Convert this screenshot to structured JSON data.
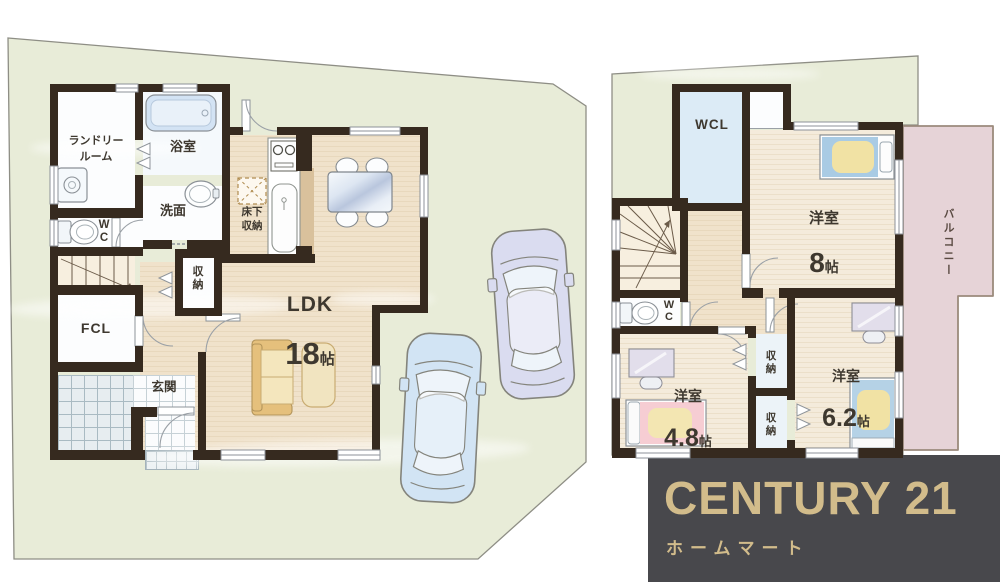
{
  "floor1": {
    "laundry": "ランドリー\nルーム",
    "bath": "浴室",
    "washroom": "洗面",
    "wc": "W\nC",
    "storage": "収\n納",
    "underfloor_storage": "床下\n収納",
    "ldk": "LDK",
    "ldk_size": "18",
    "ldk_unit": "帖",
    "fcl": "FCL",
    "entrance": "玄関"
  },
  "floor2": {
    "wcl": "WCL",
    "wc": "W\nC",
    "room8": "洋室",
    "room8_size": "8",
    "room8_unit": "帖",
    "room48": "洋室",
    "room48_size": "4.8",
    "room48_unit": "帖",
    "room62": "洋室",
    "room62_size": "6.2",
    "room62_unit": "帖",
    "storage_top": "収\n納",
    "storage_bottom": "収\n納",
    "balcony": "バルコニー"
  },
  "branding": {
    "company": "CENTURY 21",
    "store": "ホームマート",
    "text_color": "#d2bc8b",
    "bg_color": "#48484c"
  },
  "colors": {
    "wall": "#362a1f",
    "site_green": "#e8ecd8",
    "floor_wood": "#f0e2cb",
    "floor_bedroom": "#f4ebdb",
    "balcony_pink": "#e6d3d7",
    "wcl_blue": "#dcebf6"
  }
}
